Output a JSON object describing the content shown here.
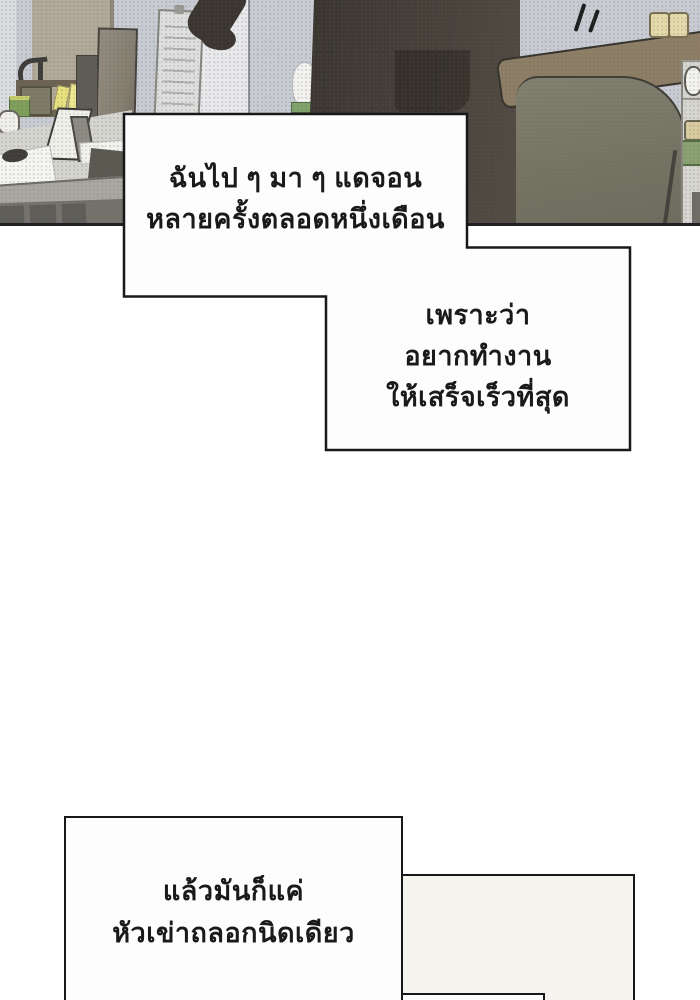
{
  "bubbles": {
    "bubble1": {
      "lines": [
        "ฉันไป ๆ มา ๆ แดจอน",
        "หลายครั้งตลอดหนึ่งเดือน"
      ]
    },
    "bubble2": {
      "lines": [
        "เพราะว่า",
        "อยากทำงาน",
        "ให้เสร็จเร็วที่สุด"
      ]
    },
    "bubble3": {
      "lines": [
        "แล้วมันก็แค่",
        "หัวเข่าถลอกนิดเดียว"
      ]
    },
    "bubble4": {
      "lines": []
    },
    "text_color": "#1a1a1a",
    "bubble_fill": "#fdfdfe",
    "bubble4_fill": "#f6f4ef",
    "border_color": "#18181a"
  },
  "scene": {
    "description": "Office interior: cluttered desk with monitor, organizer shelf, sticky notes and photo frame on the left; person in a dark suit standing beside a gray office chair with brown headrest; wall chart, partition pillar, light switches and a side desk on the right; motion lines above the chair",
    "colors": {
      "wall": "#c9ccd3",
      "partition_strip": "#e9eaec",
      "cubicle_panel": "#b3ab9a",
      "monitor": "#8b8577",
      "desk_surface": "#d6d5cf",
      "desk_front": "#aaa8a0",
      "drawers": "#74726b",
      "person_suit": "#3a352e",
      "chair_headrest": "#8e7e65",
      "chair_back": "#7c7a69",
      "light_switch": "#e4daab",
      "accent_green": "#7f9f5b",
      "sticky_note": "#e9e27e",
      "panel_border": "#202024"
    },
    "objects": [
      "desk-lamp",
      "pen-basket",
      "organizer-rails",
      "sticky-notes",
      "highlighter-box",
      "coffee-cup",
      "monitor",
      "photo-frame",
      "papers",
      "computer-mouse",
      "wall-chart",
      "tissue",
      "person",
      "office-chair",
      "light-switches",
      "motion-lines",
      "side-desk"
    ]
  }
}
